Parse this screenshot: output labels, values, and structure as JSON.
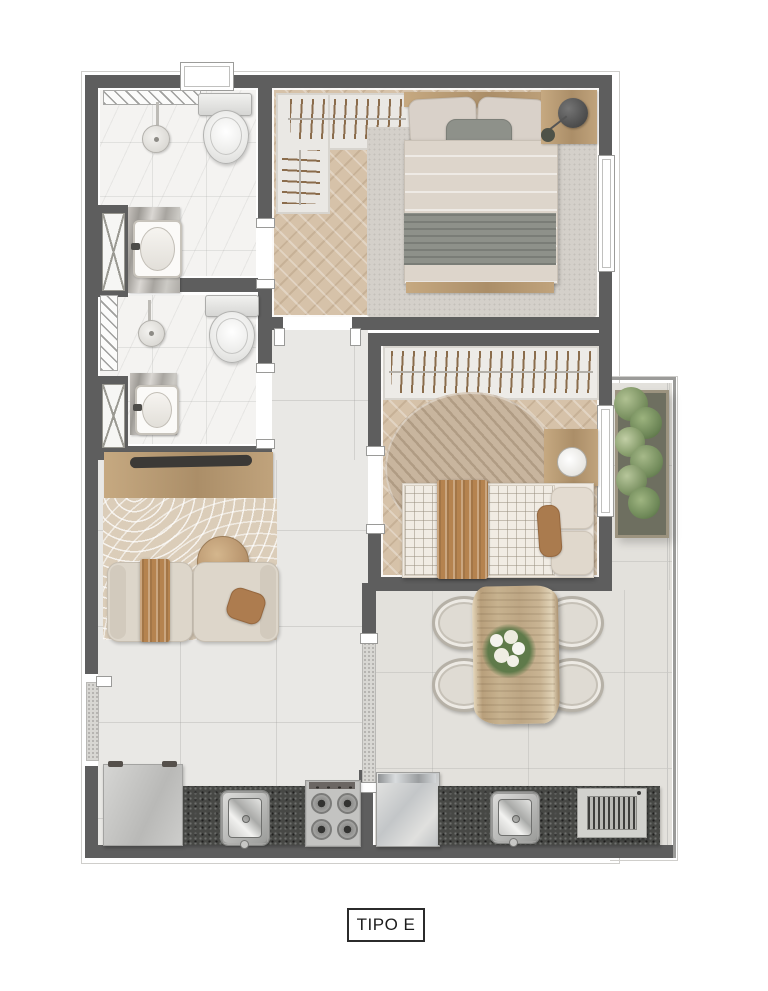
{
  "title": {
    "label": "TIPO E"
  },
  "colors": {
    "wall": "#5e5e5e",
    "tile-floor": "#e9e8e5",
    "marble-floor": "#f4f3f1",
    "wood-floor": "#d6c2a9",
    "balcony-floor": "#e3e1dc",
    "counter-dark": "#474845",
    "accent-brown": "#b5834f",
    "sofa-beige": "#ddd6ca",
    "blanket-gray": "#8e918a",
    "plant-green": "#7a9161",
    "label-ink": "#1c1c1c"
  },
  "plan": {
    "type_label": "TIPO E",
    "rooms": [
      "bathroom-ensuite",
      "bathroom-social",
      "bedroom-main",
      "bedroom-second",
      "hall",
      "living-room",
      "kitchen",
      "gourmet-balcony",
      "service-area"
    ],
    "furniture": [
      "double-bed",
      "nightstand",
      "table-lamp",
      "closet-hangers",
      "wardrobe-hangers",
      "single-bed",
      "side-desk",
      "round-rug",
      "area-rug",
      "zen-rug",
      "sideboard-desk",
      "tv",
      "modular-sofa",
      "coffee-table",
      "dining-table",
      "dining-chairs",
      "flower-centerpiece",
      "fridge",
      "kitchen-sink",
      "stove",
      "washing-machine",
      "laundry-sink",
      "barbecue-grill",
      "vertical-garden",
      "toilet",
      "shower-head",
      "washbasin",
      "ventilation-shaft",
      "sliding-door-track",
      "window"
    ]
  }
}
